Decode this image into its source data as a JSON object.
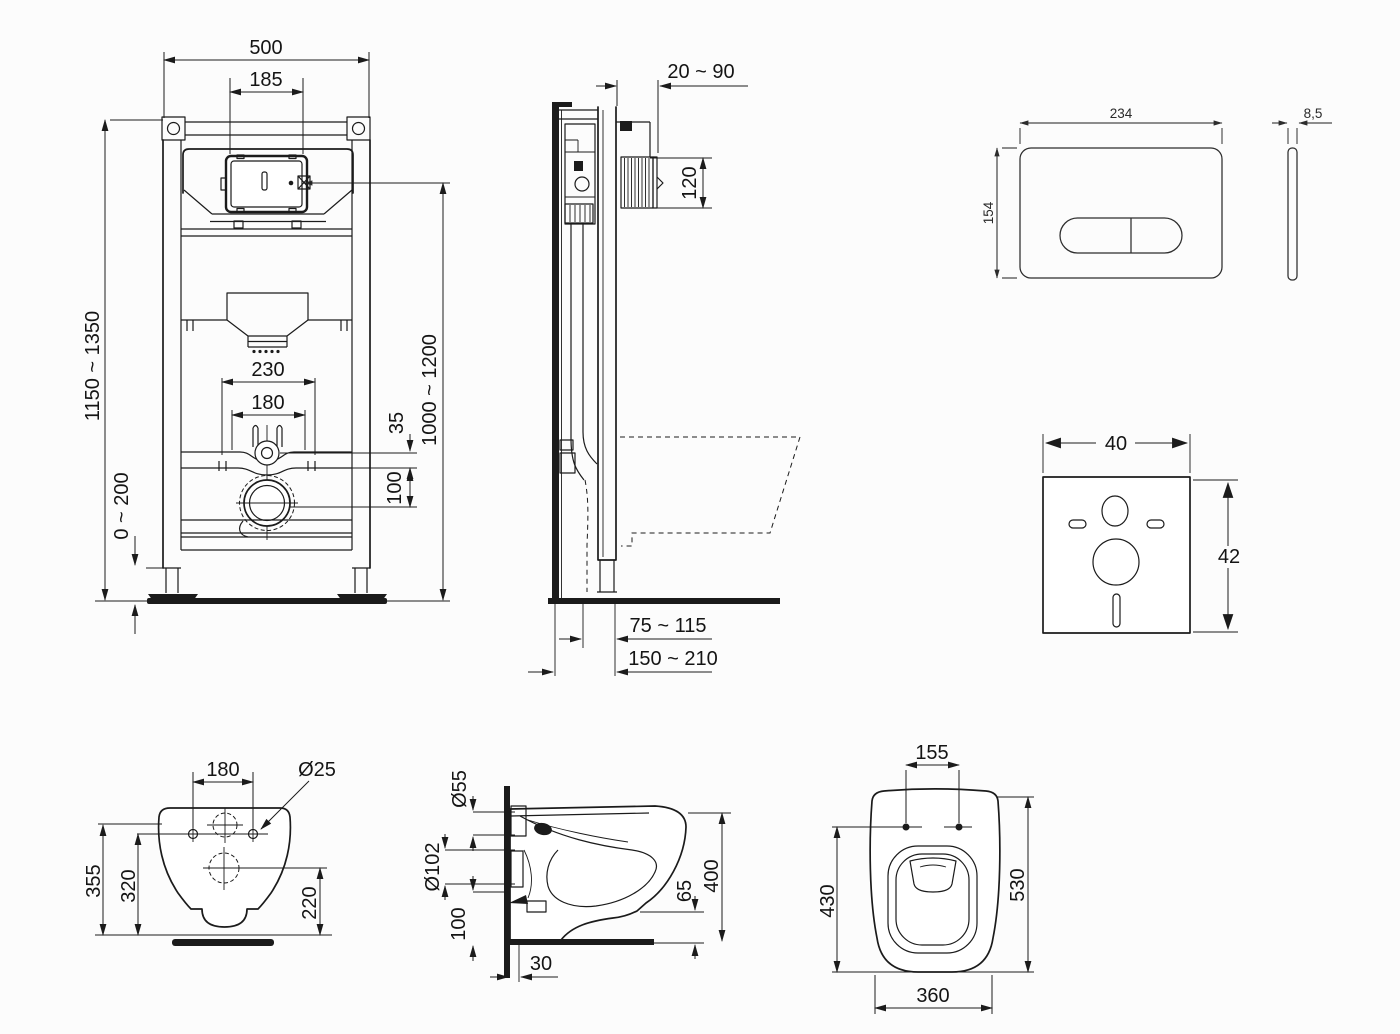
{
  "frame_front": {
    "width": "500",
    "panel_cutout_width": "185",
    "frame_height_range": "1150 ~ 1350",
    "supply_span": "230",
    "bolt_span": "180",
    "supply_drop": "35",
    "drain_drop": "100",
    "foot_adjust_range": "0 ~ 200",
    "actuator_height_range": "1000 ~ 1200"
  },
  "frame_side": {
    "wall_distance_range": "20 ~ 90",
    "duct_height": "120",
    "drain_offset_range": "75 ~ 115",
    "drain_offset_max_range": "150 ~ 210"
  },
  "flush_plate": {
    "width": "234",
    "height": "154",
    "thickness": "8,5"
  },
  "sound_pad": {
    "width": "40",
    "height": "42"
  },
  "bowl_rear": {
    "bolt_span": "180",
    "bolt_hole_diameter": "Ø25",
    "overall_height": "355",
    "bolt_height": "320",
    "drain_center_height": "220"
  },
  "bowl_side": {
    "flush_inlet_diameter": "Ø55",
    "drain_outlet_diameter": "Ø102",
    "underside_height": "100",
    "wall_clearance": "30",
    "rim_drop": "65",
    "projection": "400"
  },
  "bowl_top": {
    "seat_bolt_span": "155",
    "bolt_to_front": "430",
    "overall_length": "530",
    "overall_width": "360"
  }
}
